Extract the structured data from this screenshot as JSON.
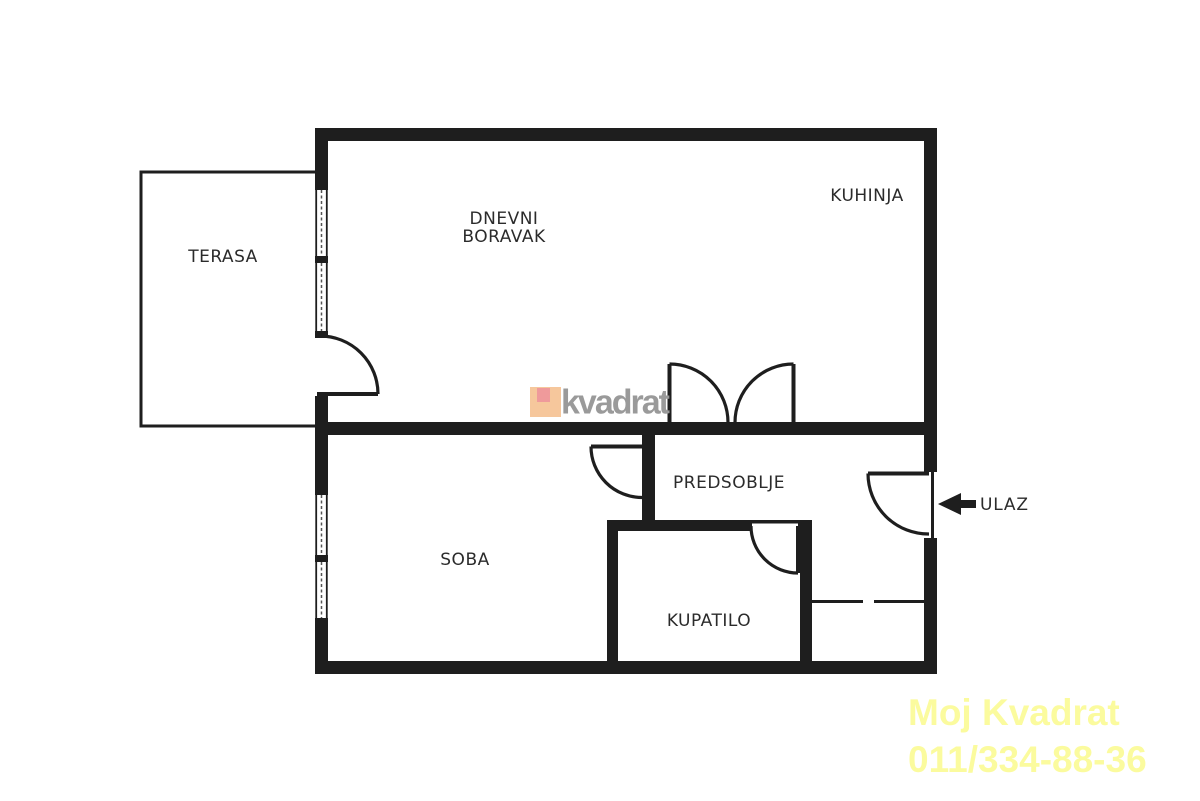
{
  "document": {
    "type": "apartment-floor-plan"
  },
  "rooms": {
    "terasa": "TERASA",
    "dnevni_boravak_line1": "DNEVNI",
    "dnevni_boravak_line2": "BORAVAK",
    "kuhinja": "KUHINJA",
    "predsoblje": "PREDSOBLJE",
    "soba": "SOBA",
    "kupatilo": "KUPATILO"
  },
  "entrance": {
    "label": "ULAZ",
    "arrow_icon": "left-arrow"
  },
  "watermark": {
    "text": "kvadrat"
  },
  "promo": {
    "company": "Moj Kvadrat",
    "phone": "011/334-88-36"
  },
  "colors": {
    "background": "#ffffff",
    "wall": "#1e1e1e",
    "label_text": "#2b2b2b",
    "watermark_text": "#9a9a9a",
    "logo_outer": "#f6c79c",
    "logo_inner": "#ef9a9b",
    "promo_text": "#fbfb9e"
  }
}
